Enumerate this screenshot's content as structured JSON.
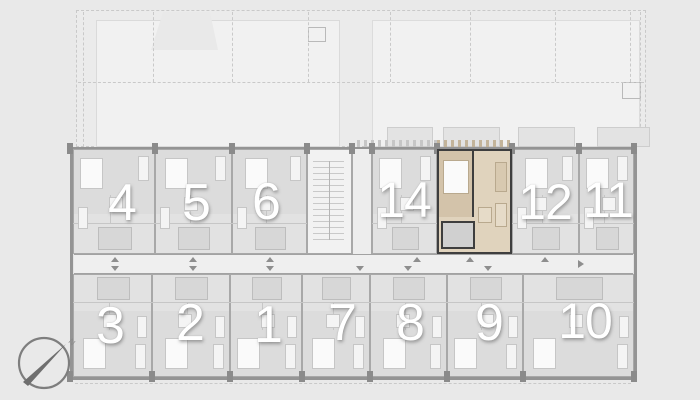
{
  "page": {
    "background": "#e9e9e9"
  },
  "plan": {
    "colors": {
      "site_fill": "#f1f1f1",
      "site_line": "#c9c9c9",
      "building_fill": "#e4e4e4",
      "wall": "#949494",
      "pier": "#8b8b8b",
      "unit_floor": "#e2e2e2",
      "bedroom_floor": "#dcdcdc",
      "furniture_fill": "#f4f4f4",
      "furniture_line": "#c6c6c6",
      "bed_fill": "#fafafa",
      "bath_fill": "#d7d7d7",
      "partition_line": "#c6c6c6",
      "corridor_fill": "#efefef",
      "stair_fill": "#f2f2f2",
      "vestibule_fill": "#ededed",
      "marker": "#8e8e8e",
      "number_fill": "#ffffff",
      "highlight_floor": "#e0d3bd",
      "highlight_bedroom": "#d3c3aa",
      "highlight_wall": "#3e3e3e",
      "highlight_bath": "#d0d0d0",
      "highlight_furniture_line": "#b9a98e",
      "balcony_fill": "#e3e3e3",
      "balcony_line": "#cdcdcd"
    },
    "building": {
      "box": [
        70,
        147,
        567,
        233
      ]
    },
    "units": [
      {
        "label": "4",
        "row": "top",
        "highlighted": false,
        "box": [
          73,
          149,
          82,
          105
        ],
        "num_pos": [
          122,
          204
        ],
        "num_size": 52
      },
      {
        "label": "5",
        "row": "top",
        "highlighted": false,
        "box": [
          155,
          149,
          77,
          105
        ],
        "num_pos": [
          196,
          204
        ],
        "num_size": 52
      },
      {
        "label": "6",
        "row": "top",
        "highlighted": false,
        "box": [
          232,
          149,
          75,
          105
        ],
        "num_pos": [
          266,
          203
        ],
        "num_size": 52
      },
      {
        "label": "14",
        "row": "top",
        "highlighted": false,
        "box": [
          372,
          149,
          65,
          105
        ],
        "num_pos": [
          404,
          201
        ],
        "num_size": 50
      },
      {
        "label": "13",
        "row": "top",
        "highlighted": true,
        "box": [
          437,
          149,
          75,
          105
        ],
        "num_pos": [
          471,
          202
        ],
        "num_size": 50
      },
      {
        "label": "12",
        "row": "top",
        "highlighted": false,
        "box": [
          512,
          149,
          67,
          105
        ],
        "num_pos": [
          545,
          203
        ],
        "num_size": 50
      },
      {
        "label": "11",
        "row": "top",
        "highlighted": false,
        "box": [
          579,
          149,
          55,
          105
        ],
        "num_pos": [
          608,
          201
        ],
        "num_size": 50
      },
      {
        "label": "3",
        "row": "bottom",
        "highlighted": false,
        "box": [
          73,
          274,
          79,
          103
        ],
        "num_pos": [
          110,
          327
        ],
        "num_size": 52
      },
      {
        "label": "2",
        "row": "bottom",
        "highlighted": false,
        "box": [
          152,
          274,
          78,
          103
        ],
        "num_pos": [
          190,
          324
        ],
        "num_size": 52
      },
      {
        "label": "1",
        "row": "bottom",
        "highlighted": false,
        "box": [
          230,
          274,
          72,
          103
        ],
        "num_pos": [
          268,
          326
        ],
        "num_size": 52
      },
      {
        "label": "7",
        "row": "bottom",
        "highlighted": false,
        "box": [
          302,
          274,
          68,
          103
        ],
        "num_pos": [
          342,
          324
        ],
        "num_size": 52
      },
      {
        "label": "8",
        "row": "bottom",
        "highlighted": false,
        "box": [
          370,
          274,
          77,
          103
        ],
        "num_pos": [
          410,
          324
        ],
        "num_size": 52
      },
      {
        "label": "9",
        "row": "bottom",
        "highlighted": false,
        "box": [
          447,
          274,
          76,
          103
        ],
        "num_pos": [
          489,
          324
        ],
        "num_size": 52
      },
      {
        "label": "10",
        "row": "bottom",
        "highlighted": false,
        "box": [
          523,
          274,
          111,
          103
        ],
        "num_pos": [
          585,
          322
        ],
        "num_size": 50
      }
    ],
    "staircase": {
      "box": [
        307,
        149,
        45,
        105
      ]
    },
    "vestibule": {
      "box": [
        352,
        149,
        20,
        105
      ]
    },
    "corridor": {
      "box": [
        74,
        254,
        559,
        20
      ],
      "up_markers": [
        115,
        193,
        270,
        417,
        470,
        545
      ],
      "down_markers": [
        115,
        193,
        270,
        360,
        408,
        488
      ],
      "right_arrow_x": 578
    },
    "balconies": [
      [
        387,
        127,
        46,
        20
      ],
      [
        443,
        127,
        57,
        20
      ],
      [
        518,
        127,
        57,
        20
      ],
      [
        597,
        127,
        53,
        20
      ]
    ],
    "deck_strips": [
      {
        "box": [
          357,
          140,
          80,
          7
        ],
        "tone": "gray"
      },
      {
        "box": [
          437,
          140,
          75,
          7
        ],
        "tone": "tan"
      }
    ],
    "site": {
      "band": [
        76,
        10,
        570,
        137
      ],
      "left_shape": [
        96,
        20,
        244,
        127
      ],
      "right_shape": [
        372,
        20,
        268,
        127
      ],
      "notch": [
        151,
        12,
        67,
        38
      ],
      "squares": [
        [
          308,
          27,
          18,
          15
        ],
        [
          622,
          82,
          19,
          17
        ]
      ],
      "v_dashes": [
        153,
        232,
        308,
        390,
        470,
        555,
        630
      ],
      "h_dash_y": 82
    },
    "compass": {
      "label": "N"
    }
  }
}
